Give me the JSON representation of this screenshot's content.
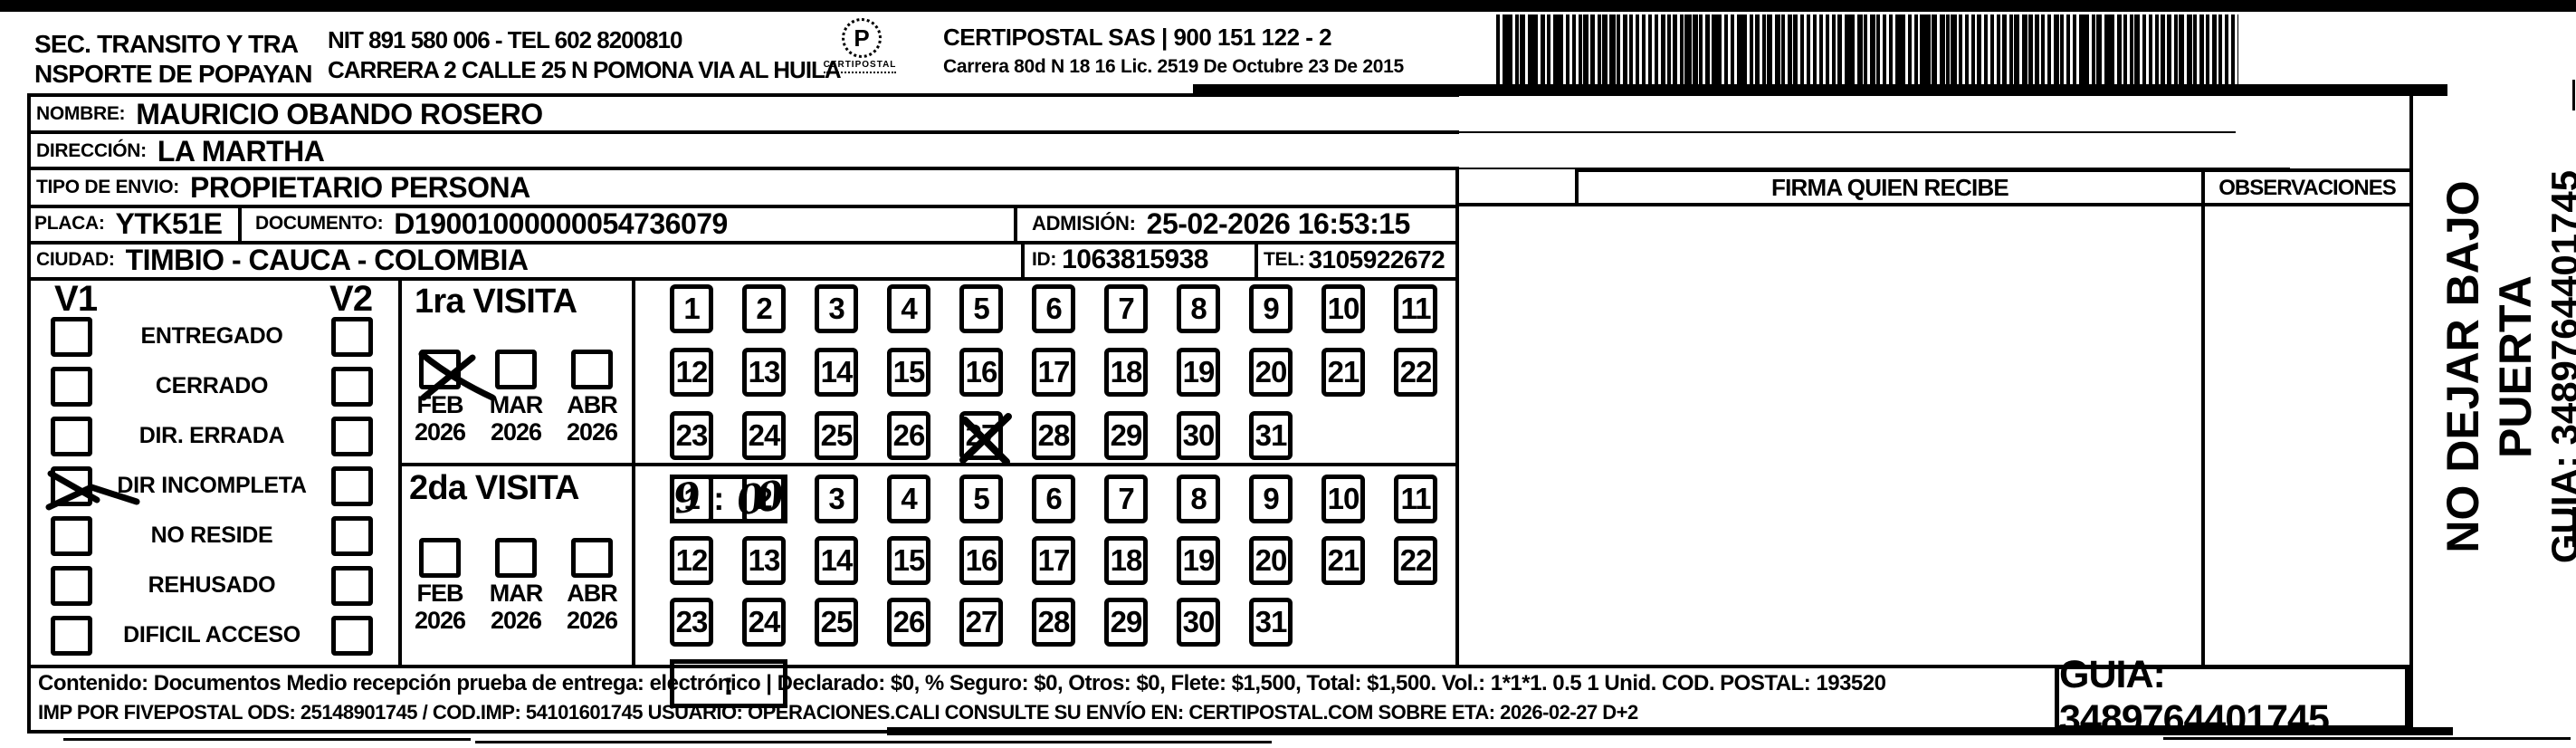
{
  "header": {
    "sender_line1": "SEC. TRANSITO Y TRA",
    "sender_line2": "NSPORTE DE POPAYAN",
    "nit_tel": "NIT 891 580 006 - TEL 602 8200810",
    "sender_address": "CARRERA 2 CALLE 25 N POMONA VIA AL HUILA",
    "logo_letter": "P",
    "logo_caption": "CERTIPOSTAL",
    "company": "CERTIPOSTAL SAS | 900 151 122 - 2",
    "company_address": "Carrera 80d N 18 16  Lic. 2519 De Octubre 23 De 2015"
  },
  "shipment": {
    "nombre_label": "NOMBRE:",
    "nombre": "MAURICIO OBANDO ROSERO",
    "direccion_label": "DIRECCIÓN:",
    "direccion": "LA MARTHA",
    "tipo_envio_label": "TIPO DE ENVIO:",
    "tipo_envio": "PROPIETARIO PERSONA",
    "placa_label": "PLACA:",
    "placa": "YTK51E",
    "documento_label": "DOCUMENTO:",
    "documento": "D19001000000054736079",
    "admision_label": "ADMISIÓN:",
    "admision": "25-02-2026 16:53:15",
    "ciudad_label": "CIUDAD:",
    "ciudad": "TIMBIO - CAUCA - COLOMBIA",
    "id_label": "ID:",
    "id_value": "1063815938",
    "tel_label": "TEL:",
    "tel": "3105922672"
  },
  "status_panel": {
    "v1_header": "V1",
    "v2_header": "V2",
    "options": [
      {
        "label": "ENTREGADO",
        "v1_checked": false,
        "v2_checked": false
      },
      {
        "label": "CERRADO",
        "v1_checked": false,
        "v2_checked": false
      },
      {
        "label": "DIR. ERRADA",
        "v1_checked": false,
        "v2_checked": false
      },
      {
        "label": "DIR INCOMPLETA",
        "v1_checked": true,
        "v2_checked": false
      },
      {
        "label": "NO RESIDE",
        "v1_checked": false,
        "v2_checked": false
      },
      {
        "label": "REHUSADO",
        "v1_checked": false,
        "v2_checked": false
      },
      {
        "label": "DIFICIL ACCESO",
        "v1_checked": false,
        "v2_checked": false
      }
    ]
  },
  "visits": [
    {
      "title": "1ra VISITA",
      "months": [
        {
          "month": "FEB",
          "year": "2026",
          "checked": true
        },
        {
          "month": "MAR",
          "year": "2026",
          "checked": false
        },
        {
          "month": "ABR",
          "year": "2026",
          "checked": false
        }
      ],
      "days": [
        1,
        2,
        3,
        4,
        5,
        6,
        7,
        8,
        9,
        10,
        11,
        12,
        13,
        14,
        15,
        16,
        17,
        18,
        19,
        20,
        21,
        22,
        23,
        24,
        25,
        26,
        27,
        28,
        29,
        30,
        31
      ],
      "crossed_days": [
        27
      ],
      "time_hour": "9",
      "time_separator": ":",
      "time_minutes": "00"
    },
    {
      "title": "2da VISITA",
      "months": [
        {
          "month": "FEB",
          "year": "2026",
          "checked": false
        },
        {
          "month": "MAR",
          "year": "2026",
          "checked": false
        },
        {
          "month": "ABR",
          "year": "2026",
          "checked": false
        }
      ],
      "days": [
        1,
        2,
        3,
        4,
        5,
        6,
        7,
        8,
        9,
        10,
        11,
        12,
        13,
        14,
        15,
        16,
        17,
        18,
        19,
        20,
        21,
        22,
        23,
        24,
        25,
        26,
        27,
        28,
        29,
        30,
        31
      ],
      "crossed_days": [],
      "time_hour": "",
      "time_separator": ":",
      "time_minutes": ""
    }
  ],
  "right_panel": {
    "firma_header": "FIRMA QUIEN RECIBE",
    "observaciones_header": "OBSERVACIONES"
  },
  "side_note": {
    "line1": "NO DEJAR BAJO PUERTA",
    "line2": "GUIA: 3489764401745"
  },
  "footer": {
    "line1": "Contenido: Documentos Medio recepción prueba de entrega: electrónico | Declarado: $0, % Seguro: $0, Otros: $0, Flete: $1,500, Total: $1,500. Vol.: 1*1*1. 0.5  1 Unid. COD. POSTAL: 193520",
    "line2": "IMP POR FIVEPOSTAL ODS: 25148901745 / COD.IMP: 54101601745 USUARIO: OPERACIONES.CALI CONSULTE SU ENVÍO EN: CERTIPOSTAL.COM SOBRE ETA: 2026-02-27 D+2",
    "guia": "GUIA: 3489764401745"
  },
  "colors": {
    "ink": "#000000",
    "paper": "#ffffff"
  }
}
